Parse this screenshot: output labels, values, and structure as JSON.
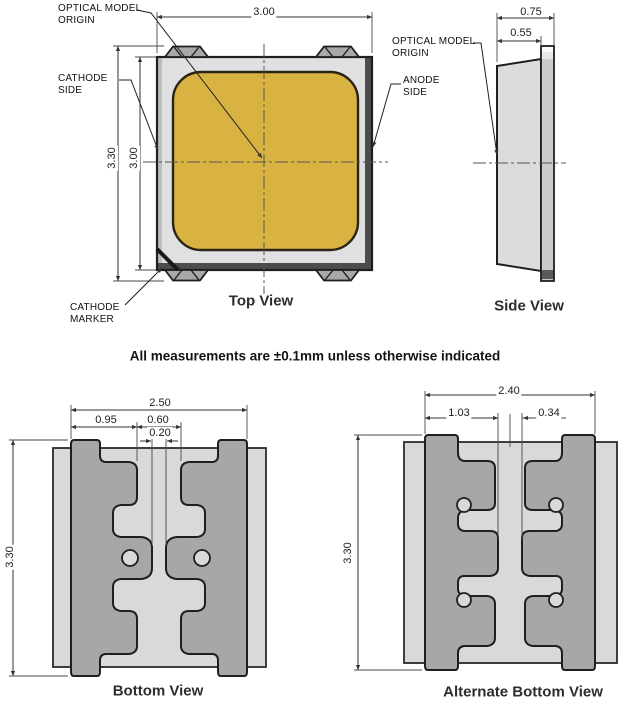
{
  "note": "All measurements are ±0.1mm unless otherwise indicated",
  "colors": {
    "phosphor_yellow": "#d9b342",
    "pad_gray": "#a7a7a9",
    "body_gray": "#d9d9db",
    "frame_gray": "#e0e0e2",
    "edge_dark": "#4c4c4e",
    "line_dark": "#1f1f1f"
  },
  "top_view": {
    "title": "Top View",
    "dims": {
      "width": "3.00",
      "height_total": "3.30",
      "height_body": "3.00"
    },
    "callouts": {
      "optical_origin_1": "OPTICAL MODEL",
      "optical_origin_2": "ORIGIN",
      "cathode_side_1": "CATHODE",
      "cathode_side_2": "SIDE",
      "anode_side_1": "ANODE",
      "anode_side_2": "SIDE",
      "cathode_marker_1": "CATHODE",
      "cathode_marker_2": "MARKER"
    }
  },
  "side_view": {
    "title": "Side View",
    "dims": {
      "thickness_total": "0.75",
      "thickness_body": "0.55"
    },
    "callouts": {
      "optical_origin_1": "OPTICAL MODEL",
      "optical_origin_2": "ORIGIN"
    }
  },
  "bottom_view": {
    "title": "Bottom View",
    "dims": {
      "pad_span": "2.50",
      "pad_width": "0.95",
      "top_gap": "0.60",
      "center_gap": "0.20",
      "height": "3.30"
    }
  },
  "alt_bottom_view": {
    "title": "Alternate Bottom View",
    "dims": {
      "pad_span": "2.40",
      "pad_width": "1.03",
      "center_gap": "0.34",
      "height": "3.30"
    }
  }
}
